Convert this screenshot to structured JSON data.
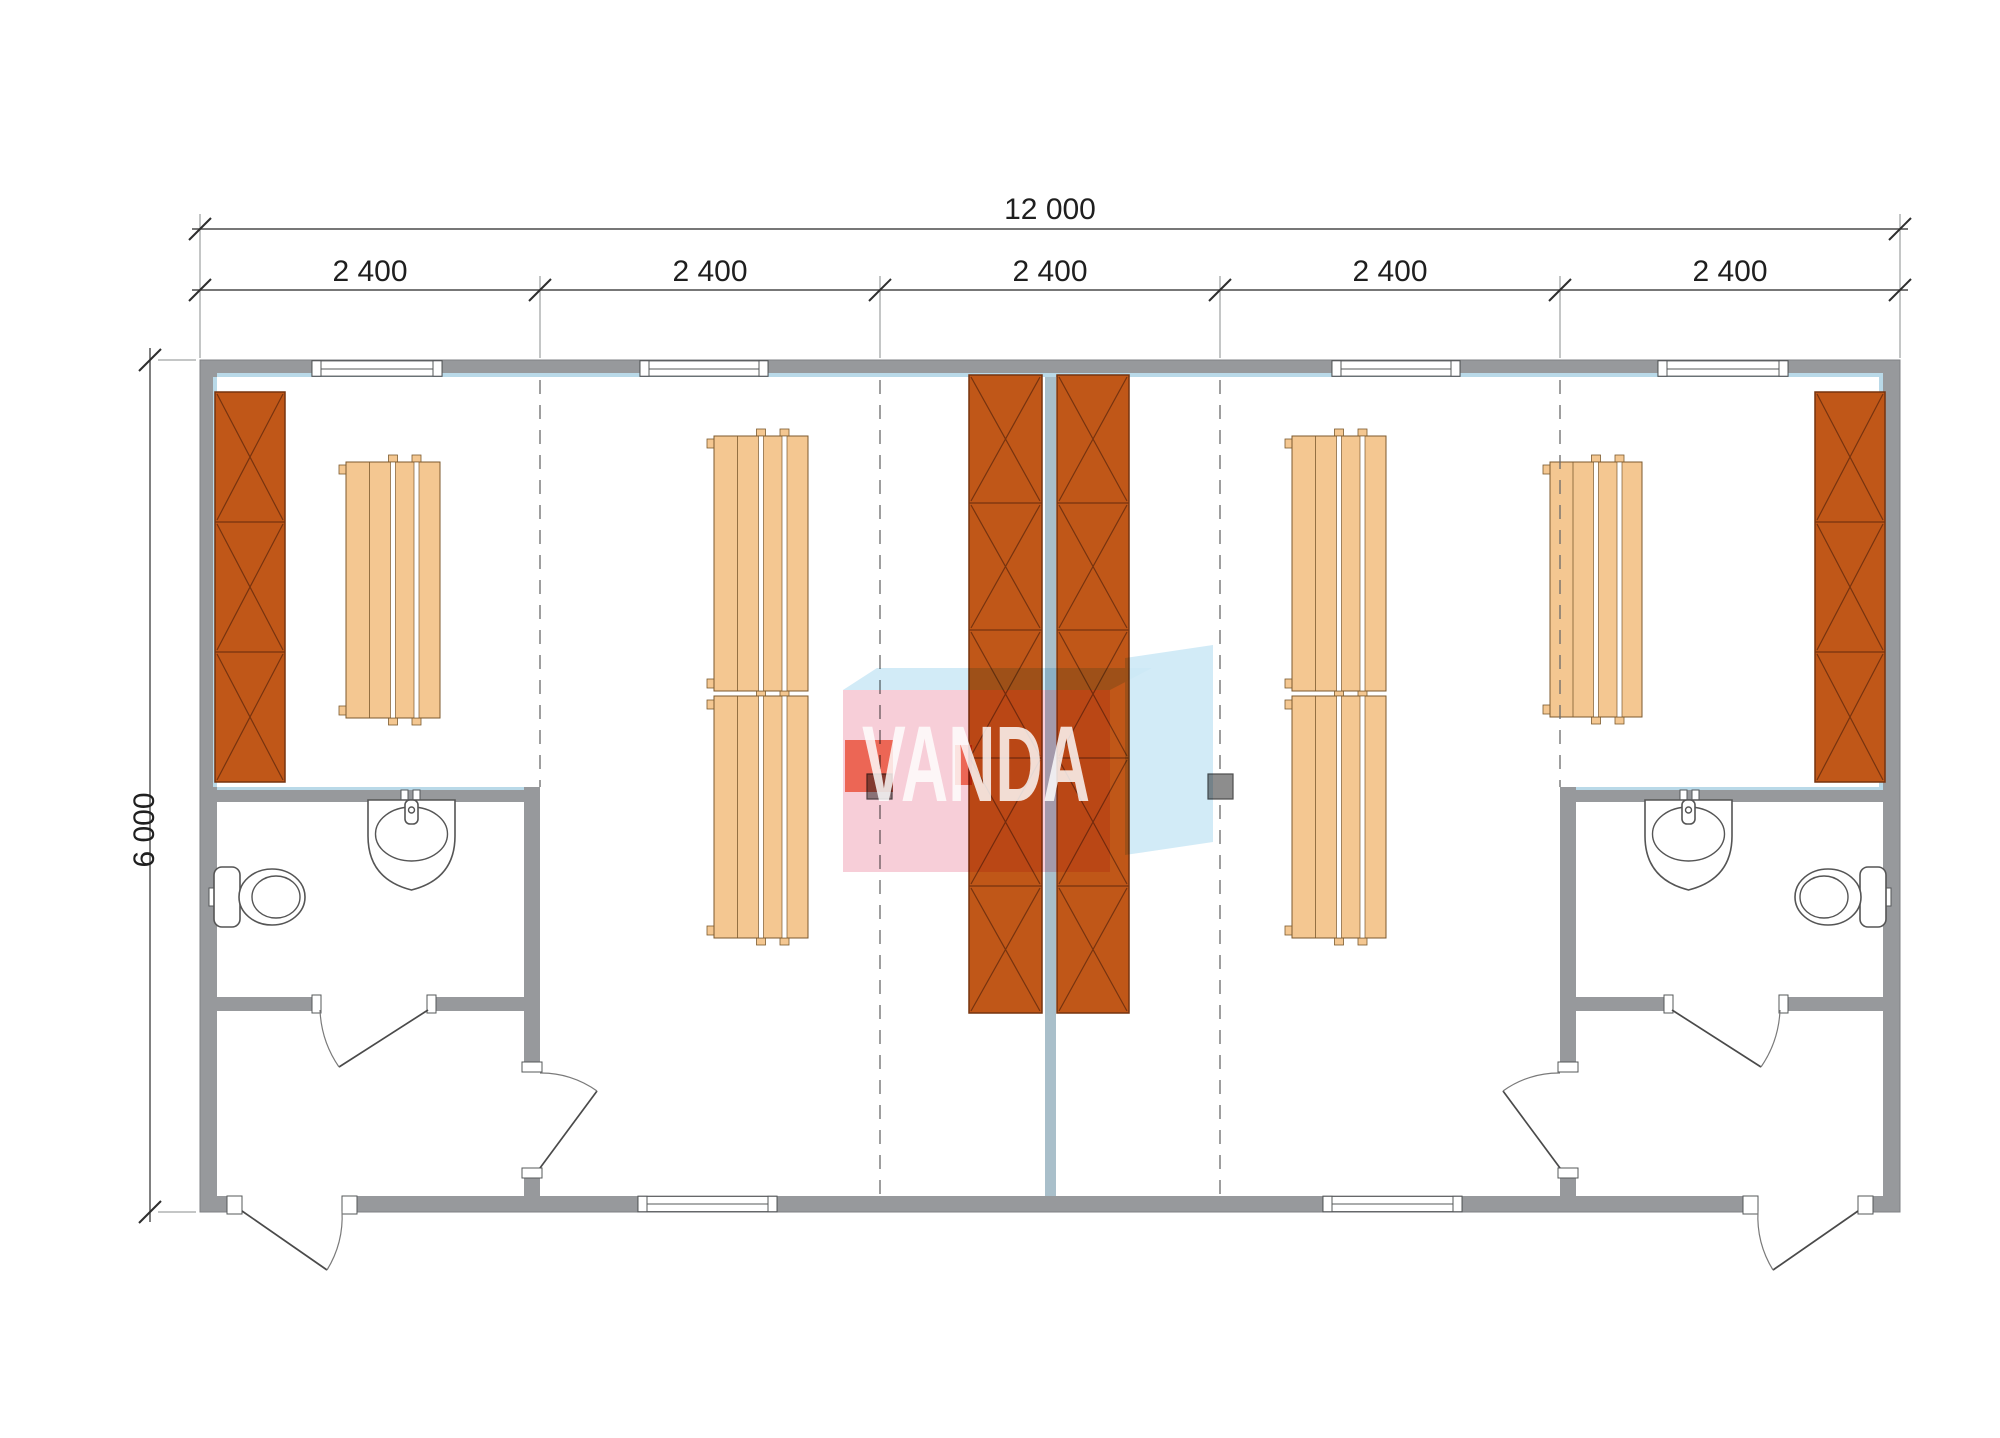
{
  "watermark": {
    "text": "VANDA"
  },
  "dimensions": {
    "total_width": "12 000",
    "building_height": "6 000",
    "modules": [
      "2 400",
      "2 400",
      "2 400",
      "2 400",
      "2 400"
    ]
  },
  "colors": {
    "floor": "#ffffff",
    "wall": "#97999c",
    "wall-edge": "#7f8184",
    "wall-lining": "#b9d9e8",
    "center-wall": "#a9bfca",
    "wardrobe": "#c05718",
    "wardrobe-line": "#76330f",
    "bench": "#f4c791",
    "bench-line": "#7c5a2e",
    "fixture-line": "#555555",
    "dim-line": "#4a4a4a",
    "dim-text": "#1f1f1f",
    "dash-line": "#6a6a6a",
    "post": "#8d8d8d",
    "post-line": "#4e4e4e",
    "logo-pink": "#f6c9d4",
    "logo-blue": "#cde9f6",
    "logo-red": "#e8442a",
    "logo-text": "#ffffff"
  }
}
